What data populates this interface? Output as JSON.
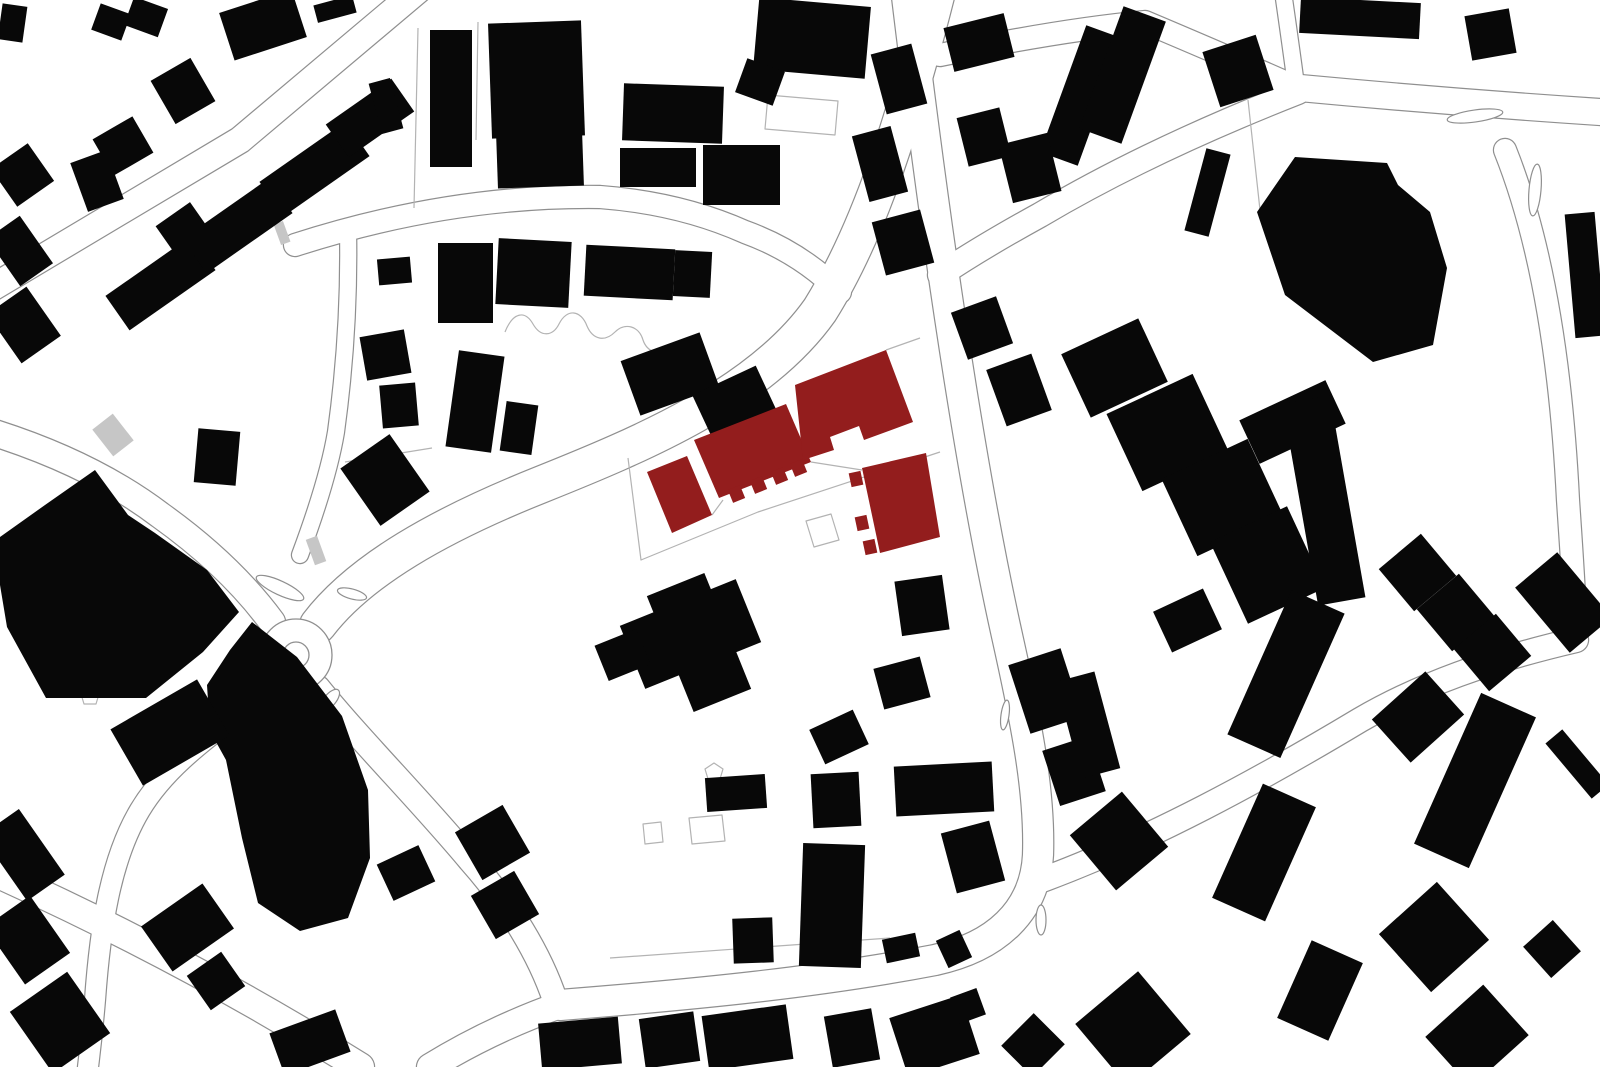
{
  "canvas": {
    "width": 1600,
    "height": 1067,
    "background": "#ffffff"
  },
  "palette": {
    "building": "#080808",
    "highlight": "#931d1d",
    "line": "#8f8f8f",
    "line_light": "#b3b3b3",
    "hatch": "#c6c6c6",
    "road_fill": "#ffffff"
  },
  "roads": [
    {
      "d": "M -20,295 L 240,140 L 430,-20",
      "w": 26
    },
    {
      "d": "M 295,245 Q 450,195 600,197 Q 680,203 745,232 Q 800,252 840,292",
      "w": 22
    },
    {
      "d": "M 348,230 Q 350,330 336,432 Q 328,480 300,555",
      "w": 16
    },
    {
      "d": "M 940,-20 C 905,120 870,230 820,310 C 760,395 640,445 540,485 C 440,525 360,570 318,625",
      "w": 36
    },
    {
      "d": "M -15,430 Q 90,462 160,515 Q 230,565 272,622",
      "w": 26
    },
    {
      "d": "M 272,688 C 220,730 170,760 140,810 C 110,860 100,930 95,1000 C 92,1035 90,1050 88,1067",
      "w": 20
    },
    {
      "d": "M 318,688 C 360,740 420,800 470,860 C 510,905 540,955 555,1000",
      "w": 24
    },
    {
      "d": "M 905,-20 C 935,230 970,470 1008,640 C 1028,730 1040,795 1038,855 C 1035,912 995,947 935,960 C 820,982 700,994 560,1005",
      "w": 30
    },
    {
      "d": "M 560,1005 Q 490,1030 430,1067",
      "w": 26
    },
    {
      "d": "M -15,868 Q 180,955 360,1067",
      "w": 28
    },
    {
      "d": "M 1042,880 C 1150,840 1260,780 1360,720 C 1420,685 1490,660 1576,640",
      "w": 24
    },
    {
      "d": "M 940,55 Q 1060,30 1145,22 Q 1235,60 1298,88",
      "w": 22
    },
    {
      "d": "M 1298,92 Q 1150,150 1040,215 Q 980,248 940,275",
      "w": 24
    },
    {
      "d": "M 1300,88 Q 1450,102 1600,112",
      "w": 26
    },
    {
      "d": "M 1282,-15 Q 1290,40 1296,85",
      "w": 16
    },
    {
      "d": "M 1505,150 C 1545,250 1562,380 1568,500 C 1572,560 1575,600 1576,640",
      "w": 22
    }
  ],
  "roundabout": {
    "cx": 296,
    "cy": 655,
    "r": 36,
    "inner_r": 13
  },
  "islands": [
    {
      "cx": 280,
      "cy": 588,
      "rx": 26,
      "ry": 7,
      "rot": 25
    },
    {
      "cx": 352,
      "cy": 594,
      "rx": 15,
      "ry": 5,
      "rot": 15
    },
    {
      "cx": 330,
      "cy": 700,
      "rx": 6,
      "ry": 13,
      "rot": 40
    },
    {
      "cx": 1475,
      "cy": 116,
      "rx": 28,
      "ry": 6,
      "rot": -8
    },
    {
      "cx": 1535,
      "cy": 190,
      "rx": 6,
      "ry": 26,
      "rot": 5
    },
    {
      "cx": 1041,
      "cy": 920,
      "rx": 5,
      "ry": 15,
      "rot": 0
    },
    {
      "cx": 1005,
      "cy": 715,
      "rx": 4,
      "ry": 15,
      "rot": 8
    }
  ],
  "parcel_lines": [
    "M 628,458 L 641,560 L 758,512 L 940,452",
    "M 712,515 L 723,500",
    "M 811,462 L 862,470",
    "M 886,350 L 920,338",
    "M 806,521 l 25,-7 l 8,26 l -25,7 Z",
    "M 643,824 l 18,-2 l 2,20 l -18,2 Z",
    "M 689,818 l 33,-3 l 3,26 l -33,3 Z",
    "M 768,95 l 70,6 l -3,34 l -70,-6 Z",
    "M 505,332 c 8,-20 20,-22 28,-8 c 8,14 20,12 26,0 c 8,-16 22,-14 28,2 c 6,14 18,16 28,6 c 10,-10 24,-6 28,8 c 4,12 16,16 28,10 c 12,-6 24,0 26,12",
    "M 418,28 L 414,208",
    "M 478,22 L 476,140",
    "M 610,958 L 890,938",
    "M 345,462 L 432,448",
    "M 1248,100 L 1260,210",
    "M 177,639 l 9,6 l -3,10 l -12,0 l -3,-10 Z",
    "M 90,688 l 9,6 l -3,10 l -12,0 l -3,-10 Z",
    "M 714,763 l 9,6 l -3,10 l -12,0 l -3,-10 Z"
  ],
  "hatch_strips": [
    {
      "r": [
        100,
        418,
        26,
        34,
        -38
      ]
    },
    {
      "r": [
        310,
        537,
        12,
        27,
        -20
      ]
    },
    {
      "r": [
        277,
        222,
        10,
        22,
        -20
      ]
    }
  ],
  "buildings": [
    {
      "r": [
        0,
        5,
        25,
        36,
        8
      ]
    },
    {
      "r": [
        95,
        8,
        32,
        28,
        20
      ]
    },
    {
      "r": [
        128,
        2,
        36,
        30,
        20
      ]
    },
    {
      "r": [
        108,
        262,
        105,
        42,
        -35
      ]
    },
    {
      "r": [
        185,
        205,
        105,
        42,
        -35
      ]
    },
    {
      "r": [
        262,
        148,
        105,
        42,
        -35
      ]
    },
    {
      "r": [
        330,
        98,
        80,
        40,
        -35
      ]
    },
    {
      "r": [
        0,
        152,
        45,
        46,
        -35
      ]
    },
    {
      "r": [
        0,
        222,
        40,
        58,
        -35
      ]
    },
    {
      "r": [
        0,
        295,
        48,
        60,
        -35
      ]
    },
    {
      "r": [
        160,
        66,
        46,
        50,
        -30
      ]
    },
    {
      "r": [
        100,
        125,
        46,
        42,
        -30
      ]
    },
    {
      "r": [
        165,
        210,
        42,
        46,
        -35
      ]
    },
    {
      "r": [
        78,
        155,
        38,
        52,
        -20
      ]
    },
    {
      "r": [
        225,
        0,
        76,
        50,
        -18
      ]
    },
    {
      "r": [
        315,
        0,
        40,
        18,
        -15
      ]
    },
    {
      "r": [
        375,
        80,
        22,
        52,
        -15
      ]
    },
    {
      "r": [
        196,
        430,
        42,
        54,
        5
      ]
    },
    {
      "r": [
        430,
        30,
        42,
        137,
        0
      ]
    },
    {
      "r": [
        490,
        22,
        93,
        115,
        -2
      ]
    },
    {
      "r": [
        497,
        132,
        86,
        55,
        -2
      ]
    },
    {
      "r": [
        623,
        85,
        100,
        57,
        2
      ]
    },
    {
      "r": [
        620,
        148,
        76,
        39,
        0
      ]
    },
    {
      "r": [
        703,
        145,
        77,
        60,
        0
      ]
    },
    {
      "r": [
        756,
        2,
        112,
        72,
        5
      ]
    },
    {
      "r": [
        740,
        64,
        40,
        36,
        20
      ]
    },
    {
      "r": [
        878,
        48,
        42,
        62,
        -15
      ]
    },
    {
      "r": [
        860,
        130,
        40,
        68,
        -15
      ]
    },
    {
      "r": [
        878,
        215,
        50,
        55,
        -15
      ]
    },
    {
      "r": [
        1062,
        28,
        40,
        135,
        20
      ]
    },
    {
      "r": [
        1100,
        10,
        45,
        130,
        20
      ]
    },
    {
      "r": [
        1195,
        150,
        25,
        85,
        15
      ]
    },
    {
      "r": [
        1210,
        42,
        56,
        58,
        -18
      ]
    },
    {
      "r": [
        1300,
        0,
        120,
        36,
        3
      ]
    },
    {
      "p": [
        [
          1295,
          157
        ],
        [
          1387,
          163
        ],
        [
          1398,
          185
        ],
        [
          1430,
          212
        ],
        [
          1447,
          268
        ],
        [
          1433,
          345
        ],
        [
          1373,
          362
        ],
        [
          1285,
          295
        ],
        [
          1257,
          212
        ]
      ]
    },
    {
      "r": [
        1468,
        12,
        45,
        45,
        -10
      ]
    },
    {
      "r": [
        1570,
        213,
        30,
        124,
        -5
      ]
    },
    {
      "r": [
        948,
        20,
        62,
        45,
        -14
      ]
    },
    {
      "r": [
        962,
        112,
        44,
        50,
        -14
      ]
    },
    {
      "r": [
        1005,
        138,
        50,
        60,
        -14
      ]
    },
    {
      "r": [
        958,
        303,
        48,
        50,
        -20
      ]
    },
    {
      "r": [
        995,
        360,
        48,
        60,
        -20
      ]
    },
    {
      "p": [
        [
          95,
          470
        ],
        [
          128,
          515
        ],
        [
          155,
          533
        ],
        [
          207,
          570
        ],
        [
          239,
          612
        ],
        [
          203,
          652
        ],
        [
          146,
          698
        ],
        [
          46,
          698
        ],
        [
          7,
          627
        ],
        [
          0,
          585
        ],
        [
          0,
          537
        ],
        [
          45,
          505
        ]
      ]
    },
    {
      "p": [
        [
          252,
          622
        ],
        [
          297,
          657
        ],
        [
          342,
          716
        ],
        [
          368,
          790
        ],
        [
          370,
          858
        ],
        [
          348,
          918
        ],
        [
          300,
          931
        ],
        [
          258,
          903
        ],
        [
          242,
          838
        ],
        [
          226,
          760
        ],
        [
          210,
          731
        ],
        [
          207,
          685
        ],
        [
          230,
          650
        ]
      ]
    },
    {
      "r": [
        120,
        700,
        100,
        65,
        -30
      ]
    },
    {
      "r": [
        378,
        258,
        33,
        26,
        -5
      ]
    },
    {
      "r": [
        363,
        333,
        45,
        44,
        -10
      ]
    },
    {
      "r": [
        381,
        384,
        36,
        43,
        -5
      ]
    },
    {
      "r": [
        438,
        243,
        55,
        80,
        0
      ]
    },
    {
      "r": [
        497,
        240,
        73,
        66,
        3
      ]
    },
    {
      "r": [
        585,
        247,
        89,
        51,
        3
      ]
    },
    {
      "r": [
        674,
        251,
        37,
        46,
        3
      ]
    },
    {
      "r": [
        452,
        353,
        46,
        97,
        8
      ]
    },
    {
      "r": [
        503,
        403,
        32,
        50,
        8
      ]
    },
    {
      "r": [
        628,
        345,
        84,
        58,
        -20
      ]
    },
    {
      "r": [
        700,
        378,
        70,
        52,
        -25
      ]
    },
    {
      "r": [
        355,
        445,
        60,
        70,
        -35
      ]
    },
    {
      "r": [
        628,
        600,
        125,
        68,
        -22
      ]
    },
    {
      "r": [
        668,
        580,
        62,
        125,
        -22
      ]
    },
    {
      "r": [
        600,
        636,
        45,
        38,
        -22
      ]
    },
    {
      "r": [
        815,
        718,
        48,
        38,
        -25
      ]
    },
    {
      "r": [
        878,
        662,
        48,
        42,
        -15
      ]
    },
    {
      "r": [
        898,
        578,
        48,
        55,
        -8
      ]
    },
    {
      "r": [
        895,
        764,
        98,
        50,
        -3
      ]
    },
    {
      "r": [
        706,
        776,
        60,
        34,
        -4
      ]
    },
    {
      "r": [
        812,
        773,
        48,
        54,
        -3
      ]
    },
    {
      "r": [
        801,
        844,
        62,
        123,
        2
      ]
    },
    {
      "r": [
        733,
        918,
        40,
        45,
        -2
      ]
    },
    {
      "r": [
        884,
        936,
        34,
        24,
        -12
      ]
    },
    {
      "r": [
        941,
        934,
        26,
        30,
        -25
      ]
    },
    {
      "r": [
        948,
        826,
        50,
        62,
        -15
      ]
    },
    {
      "r": [
        1072,
        333,
        85,
        70,
        -25
      ]
    },
    {
      "r": [
        1120,
        390,
        95,
        85,
        -25
      ]
    },
    {
      "r": [
        1175,
        455,
        95,
        85,
        -25
      ]
    },
    {
      "r": [
        1245,
        398,
        95,
        48,
        -25
      ]
    },
    {
      "r": [
        1225,
        520,
        85,
        90,
        -25
      ]
    },
    {
      "r": [
        1160,
        598,
        55,
        45,
        -25
      ]
    },
    {
      "r": [
        1300,
        398,
        48,
        205,
        -10
      ]
    },
    {
      "r": [
        1390,
        545,
        55,
        55,
        -40
      ]
    },
    {
      "r": [
        1428,
        585,
        55,
        55,
        -40
      ]
    },
    {
      "r": [
        1465,
        625,
        55,
        55,
        -40
      ]
    },
    {
      "r": [
        1536,
        560,
        55,
        85,
        -40
      ]
    },
    {
      "r": [
        1566,
        728,
        22,
        72,
        -40
      ]
    },
    {
      "r": [
        1257,
        595,
        58,
        158,
        24
      ]
    },
    {
      "r": [
        1235,
        790,
        58,
        125,
        24
      ]
    },
    {
      "r": [
        1382,
        688,
        72,
        58,
        -42
      ]
    },
    {
      "r": [
        1445,
        698,
        60,
        165,
        24
      ]
    },
    {
      "r": [
        1018,
        655,
        55,
        72,
        -18
      ]
    },
    {
      "r": [
        1050,
        742,
        48,
        58,
        -18
      ]
    },
    {
      "r": [
        1068,
        675,
        40,
        100,
        -15
      ]
    },
    {
      "r": [
        1085,
        805,
        68,
        72,
        -40
      ]
    },
    {
      "r": [
        1395,
        898,
        78,
        78,
        -42
      ]
    },
    {
      "r": [
        1532,
        928,
        40,
        42,
        -42
      ]
    },
    {
      "r": [
        1092,
        988,
        82,
        82,
        -40
      ]
    },
    {
      "r": [
        1292,
        948,
        56,
        85,
        24
      ]
    },
    {
      "r": [
        1438,
        1002,
        78,
        68,
        -42
      ]
    },
    {
      "r": [
        540,
        1020,
        80,
        47,
        -5
      ]
    },
    {
      "r": [
        642,
        1015,
        55,
        50,
        -8
      ]
    },
    {
      "r": [
        705,
        1010,
        85,
        55,
        -8
      ]
    },
    {
      "r": [
        828,
        1012,
        48,
        52,
        -10
      ]
    },
    {
      "r": [
        897,
        1005,
        75,
        62,
        -18
      ]
    },
    {
      "r": [
        954,
        992,
        28,
        28,
        -20
      ]
    },
    {
      "r": [
        1010,
        1023,
        46,
        44,
        -45
      ]
    },
    {
      "r": [
        383,
        853,
        46,
        40,
        -25
      ]
    },
    {
      "r": [
        465,
        815,
        55,
        55,
        -30
      ]
    },
    {
      "r": [
        480,
        880,
        50,
        50,
        -30
      ]
    },
    {
      "r": [
        0,
        815,
        46,
        80,
        -35
      ]
    },
    {
      "r": [
        0,
        905,
        55,
        70,
        -35
      ]
    },
    {
      "r": [
        25,
        985,
        70,
        75,
        -35
      ]
    },
    {
      "r": [
        150,
        900,
        75,
        55,
        -35
      ]
    },
    {
      "r": [
        195,
        960,
        42,
        42,
        -35
      ]
    },
    {
      "r": [
        275,
        1020,
        70,
        45,
        -20
      ]
    }
  ],
  "highlighted_buildings": [
    {
      "p": [
        [
          647,
          472
        ],
        [
          687,
          456
        ],
        [
          712,
          515
        ],
        [
          672,
          533
        ]
      ]
    },
    {
      "p": [
        [
          694,
          440
        ],
        [
          786,
          404
        ],
        [
          811,
          462
        ],
        [
          719,
          498
        ]
      ]
    },
    {
      "r": [
        730,
        487,
        13,
        14,
        -22
      ]
    },
    {
      "r": [
        752,
        478,
        13,
        14,
        -22
      ]
    },
    {
      "r": [
        773,
        469,
        13,
        14,
        -22
      ]
    },
    {
      "r": [
        792,
        461,
        13,
        14,
        -22
      ]
    },
    {
      "p": [
        [
          795,
          385
        ],
        [
          886,
          350
        ],
        [
          913,
          422
        ],
        [
          864,
          440
        ],
        [
          859,
          426
        ],
        [
          830,
          437
        ],
        [
          834,
          450
        ],
        [
          803,
          460
        ]
      ]
    },
    {
      "p": [
        [
          862,
          468
        ],
        [
          926,
          453
        ],
        [
          940,
          537
        ],
        [
          880,
          553
        ]
      ]
    },
    {
      "r": [
        850,
        472,
        12,
        14,
        -12
      ]
    },
    {
      "r": [
        856,
        516,
        12,
        14,
        -12
      ]
    },
    {
      "r": [
        864,
        540,
        12,
        14,
        -12
      ]
    }
  ]
}
